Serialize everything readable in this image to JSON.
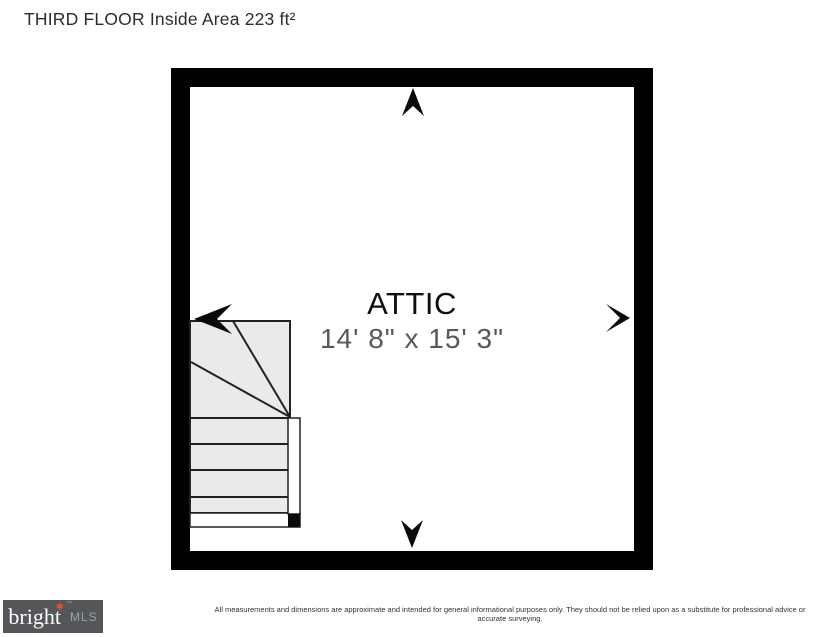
{
  "page": {
    "title": "THIRD FLOOR Inside Area 223 ft²"
  },
  "plan": {
    "room": {
      "name": "ATTIC",
      "dimensions": "14' 8\" x 15' 3\""
    },
    "features": [
      "staircase-with-winder",
      "arrow-up",
      "arrow-down",
      "arrow-left",
      "arrow-right"
    ]
  },
  "footer": {
    "disclaimer": "All measurements and dimensions are approximate and intended for general informational purposes only. They should not be relied upon as a substitute for professional advice or accurate surveying.",
    "logo": {
      "brand": "bright",
      "star": "✱",
      "trademark": "™",
      "suffix": "MLS"
    }
  },
  "colors": {
    "wall": "#000000",
    "stair_fill": "#e9eae9",
    "stair_line": "#222222",
    "room_name_text": "#0f0f0f",
    "dimension_text": "#585858",
    "logo_bg": "#54565a",
    "logo_star": "#e0552e",
    "logo_suffix_text": "#9aa0a6"
  }
}
